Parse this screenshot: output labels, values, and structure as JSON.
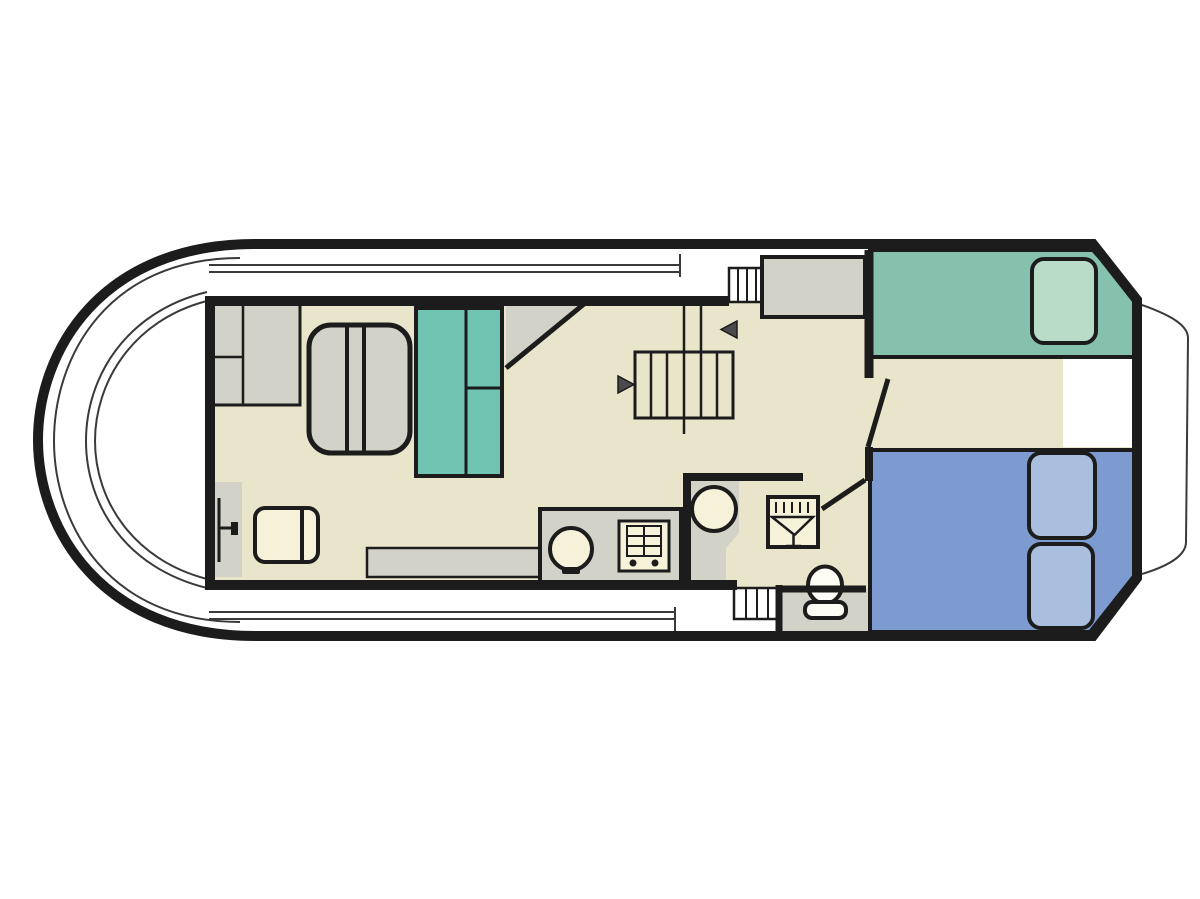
{
  "page": {
    "title": "Canal boat deck floor plan"
  },
  "colors": {
    "paper": "#ffffff",
    "ink": "#1c1c1c",
    "line": "#3a3a3a",
    "floor": "#e9e5ca",
    "gray": "#d2d2c8",
    "teal": "#6fc4b2",
    "bedGreen": "#85c1ac",
    "pillowGreen": "#b9dcc9",
    "bedBlue": "#7d9bd1",
    "pillowBlue": "#aabede",
    "ivory": "#f6f2da",
    "white": "#fdfdf6",
    "arrow": "#4a4a4a"
  },
  "icons": {
    "shower-icon": "square with funnel glyph and spray ticks",
    "toilet-icon": "oval bowl with seat base",
    "sink-icon": "circle with tap mark",
    "stove-icon": "square with burner grid and two knobs",
    "direction-arrow-icon": "small solid triangle",
    "stairs-icon": "rectangle with tread lines"
  },
  "legend": {
    "bow-deck": "open bow deck with coaming",
    "saloon": "forward saloon with table, cabinets and wardrobe",
    "helm": "helm door and helm seat",
    "galley": "counter with sink and stove",
    "stairwell": "central companionway stairs with entry arrows",
    "bathroom": "washbasin, shower and toilet",
    "aft-cabin": "single berth (green) and double berth (blue)",
    "stern": "swim platform outline"
  }
}
